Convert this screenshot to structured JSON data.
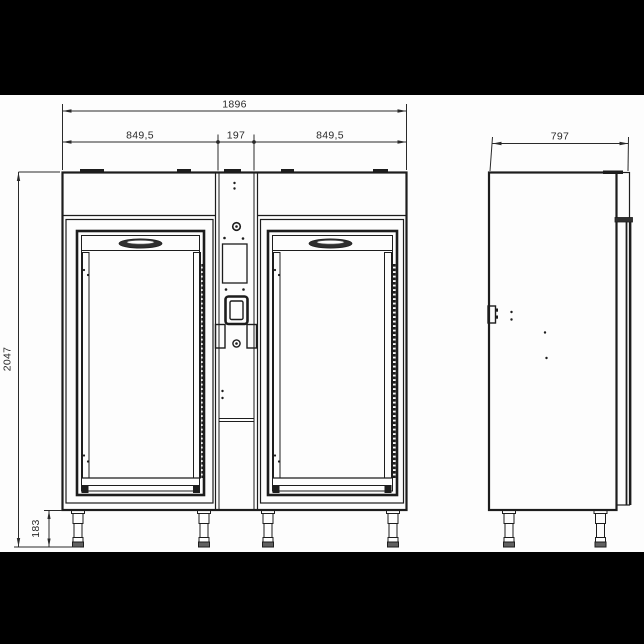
{
  "dimensions": {
    "total_width": "1896",
    "left_door_width": "849,5",
    "center_panel_width": "197",
    "right_door_width": "849,5",
    "depth": "797",
    "total_height": "2047",
    "leg_height": "183"
  },
  "colors": {
    "letterbox": "#000000",
    "paper": "#fdfdfd",
    "line": "#1d1d1d",
    "dim_line": "#2a2a2a",
    "dark_fill": "#2f2f2f",
    "foot_fill": "#606060"
  }
}
